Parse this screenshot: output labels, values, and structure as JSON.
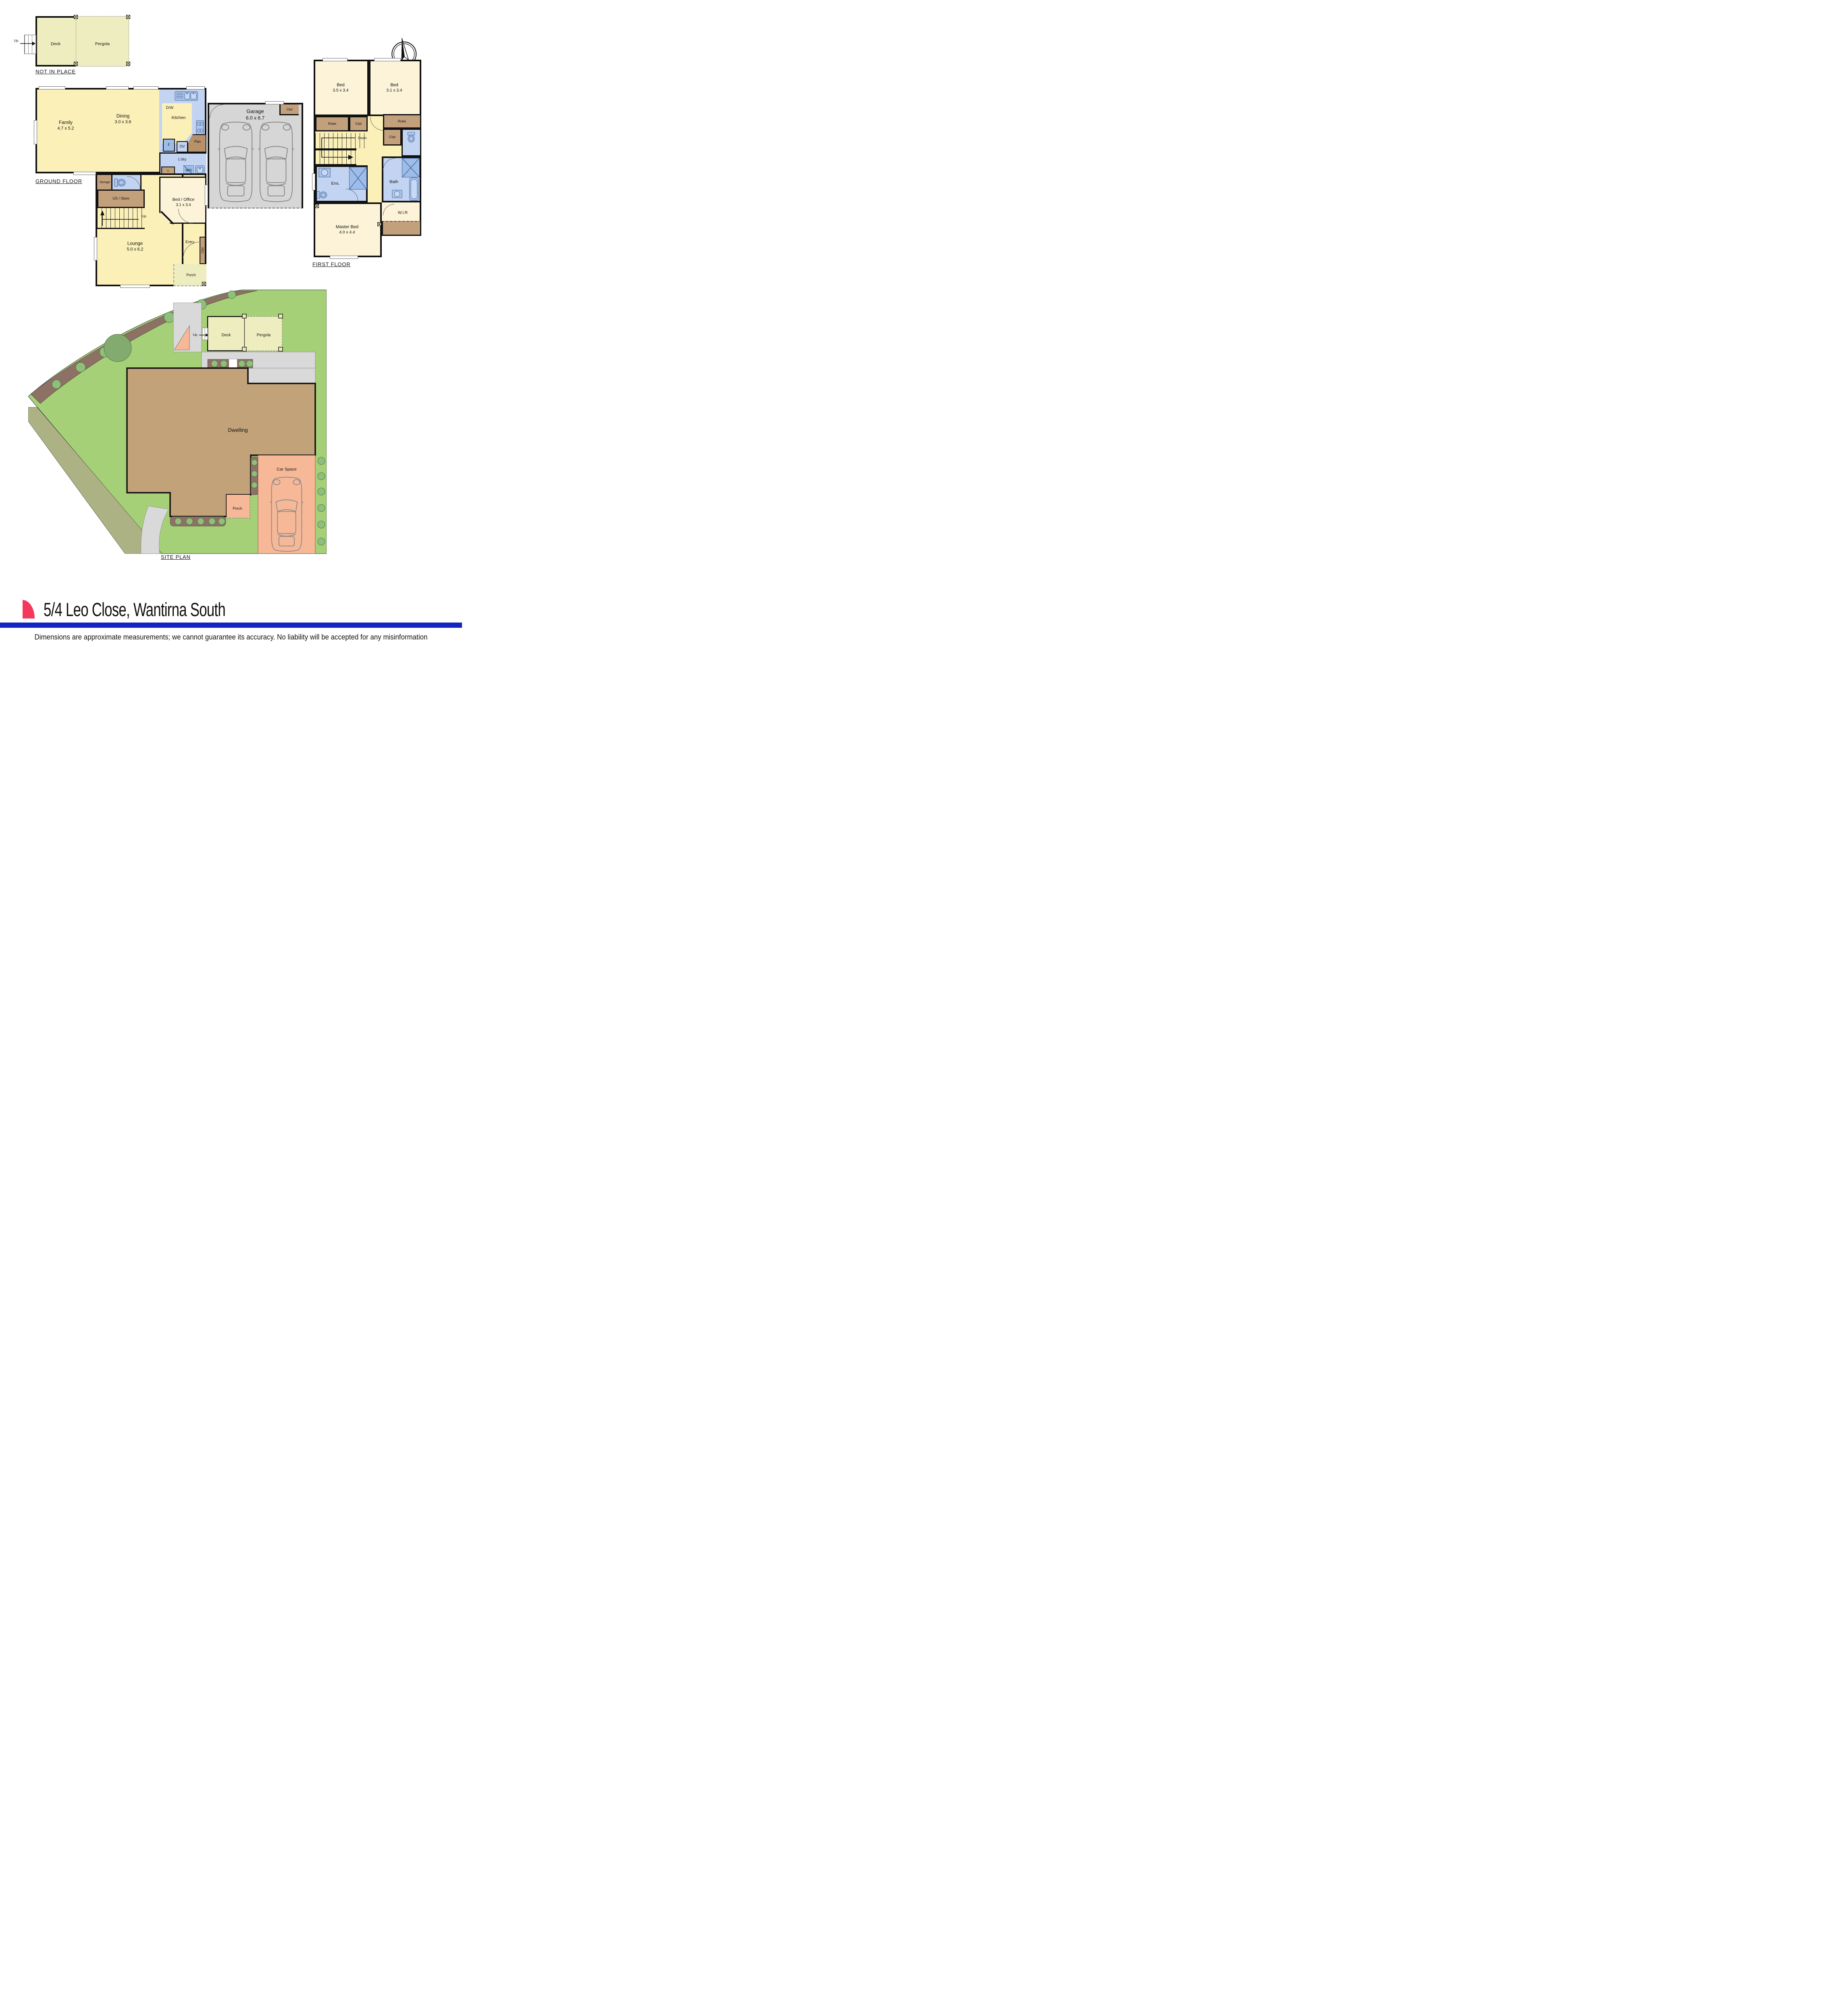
{
  "palette": {
    "wall": "#111111",
    "cream": "#FAF0B8",
    "cream_light": "#FCF3D8",
    "blue_room": "#C3D4F2",
    "blue_fix": "#9DBCE8",
    "tan": "#C2A07C",
    "tan_dark": "#B8916B",
    "deck": "#EDEDBF",
    "garage_gray": "#D6D6D6",
    "grass": "#A6D077",
    "bed_brown": "#8C7164",
    "tree": "#8FBF7A",
    "tree_big": "#83AA6F",
    "olive": "#ACB284",
    "path_gray": "#D9D9D9",
    "dwelling": "#C2A278",
    "salmon": "#F6B897",
    "bar_blue": "#1423C4",
    "logo_red": "#F5395C",
    "post": "#EAECC0"
  },
  "sections": {
    "not_in_place": {
      "heading": "NOT IN PLACE",
      "deck": "Deck",
      "pergola": "Pergola",
      "up": "Up"
    },
    "ground": {
      "heading": "GROUND FLOOR",
      "family": {
        "name": "Family",
        "dims": "4.7 x 5.2"
      },
      "dining": {
        "name": "Dining",
        "dims": "3.0 x 3.6"
      },
      "kitchen": "Kitchen",
      "dw": "D/W",
      "fridge": "F",
      "oven": "OV",
      "pantry": "Pan",
      "laundry": "L'dry",
      "washer": "W/D",
      "cupboard_small": "c",
      "storage": "Storage",
      "understair": "US / Store",
      "stairs_up": "Up",
      "bed_office": {
        "name": "Bed / Office",
        "dims": "3.1 x 3.4"
      },
      "lounge": {
        "name": "Lounge",
        "dims": "5.0 x 6.2"
      },
      "entry": "Entry",
      "entry_cbd": "Cbd",
      "porch": "Porch",
      "garage": {
        "name": "Garage",
        "dims": "6.0 x 6.7"
      },
      "garage_cbd": "Cbd"
    },
    "first": {
      "heading": "FIRST FLOOR",
      "bed_left": {
        "name": "Bed",
        "dims": "3.5 x 3.4"
      },
      "bed_right": {
        "name": "Bed",
        "dims": "3.1 x 3.4"
      },
      "robe_left": "Robe",
      "cbd_left": "Cbd",
      "robe_right": "Robe",
      "cbd_right": "Cbd",
      "stairs_down": "Down",
      "ensuite": "Ens.",
      "bath": "Bath",
      "wir": "W.I.R",
      "master": {
        "name": "Master Bed",
        "dims": "4.0 x 4.4"
      }
    },
    "site": {
      "heading": "SITE PLAN",
      "deck": "Deck",
      "pergola": "Pergola",
      "up": "Up",
      "dwelling": "Dwelling",
      "car_space": "Car Space",
      "porch": "Porch"
    }
  },
  "footer": {
    "address": "5/4 Leo Close, Wantirna South",
    "disclaimer": "Dimensions are approximate measurements; we cannot guarantee its accuracy. No liability will be accepted for any misinformation"
  }
}
